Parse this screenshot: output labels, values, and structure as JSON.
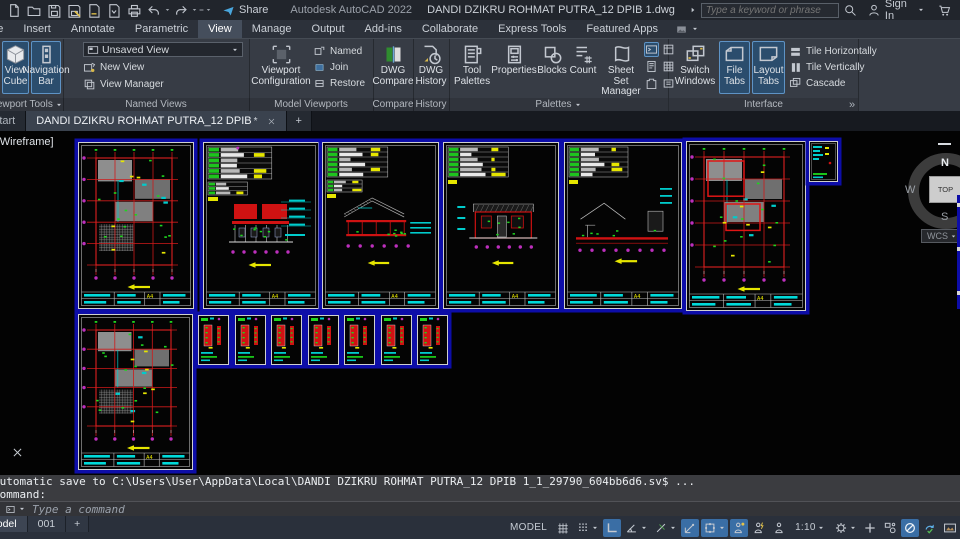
{
  "colors": {
    "highlight_blue": "#2b4d6d",
    "active_toggle": "#3a6ea5",
    "sheet_backdrop": "#0d0da8",
    "cad_red": "#cf1212",
    "cad_green": "#1fd41f",
    "cad_cyan": "#00cccc",
    "cad_magenta": "#bd2fbd",
    "cad_yellow": "#e6e600"
  },
  "titlebar": {
    "app": "Autodesk AutoCAD 2022",
    "doc": "DANDI DZIKRU ROHMAT PUTRA_12 DPIB 1.dwg",
    "share": "Share",
    "search_placeholder": "Type a keyword or phrase",
    "sign_in": "Sign In"
  },
  "menu": {
    "tabs": [
      {
        "label": "Home",
        "clip": true
      },
      {
        "label": "Insert"
      },
      {
        "label": "Annotate"
      },
      {
        "label": "Parametric"
      },
      {
        "label": "View",
        "active": true
      },
      {
        "label": "Manage"
      },
      {
        "label": "Output"
      },
      {
        "label": "Add-ins"
      },
      {
        "label": "Collaborate"
      },
      {
        "label": "Express Tools"
      },
      {
        "label": "Featured Apps"
      },
      {
        "icon": "imgbtn",
        "caret": true,
        "name": "workspace-thumbnail-menu"
      }
    ]
  },
  "ribbon": {
    "overflow": "»",
    "viewport_tools": {
      "label": "Viewport Tools",
      "view_cube": "View Cube",
      "navigation_bar": "Navigation Bar"
    },
    "named_views": {
      "label": "Named Views",
      "combo_value": "Unsaved View",
      "new_view": "New View",
      "view_manager": "View Manager"
    },
    "model_viewports": {
      "label": "Model Viewports",
      "viewport_configuration": "Viewport Configuration",
      "named": "Named",
      "join": "Join",
      "restore": "Restore"
    },
    "compare": {
      "label": "Compare",
      "dwg_compare": "DWG Compare"
    },
    "history": {
      "label": "History",
      "dwg_history": "DWG History"
    },
    "palettes": {
      "label": "Palettes",
      "tool_palettes": "Tool Palettes",
      "properties": "Properties",
      "blocks": "Blocks",
      "count": "Count",
      "sheet_set_manager": "Sheet Set Manager"
    },
    "interface": {
      "label": "Interface",
      "switch_windows": "Switch Windows",
      "file_tabs": "File Tabs",
      "layout_tabs": "Layout Tabs",
      "tile_horizontally": "Tile Horizontally",
      "tile_vertically": "Tile Vertically",
      "cascade": "Cascade"
    }
  },
  "file_tabs": {
    "start": "Start",
    "doc": "DANDI DZIKRU ROHMAT PUTRA_12 DPIB",
    "modified": "*",
    "new_tab": "+"
  },
  "canvas": {
    "vp_label": "[-][Top][2D Wireframe]",
    "viewcube": {
      "n": "N",
      "w": "W",
      "s": "S",
      "top": "TOP",
      "wcs": "WCS"
    },
    "sheets": [
      {
        "name": "sheet-1",
        "type": "plan",
        "x": 78,
        "y": 11,
        "w": 116,
        "h": 167,
        "label": "A4"
      },
      {
        "name": "sheet-2",
        "type": "elev",
        "x": 203,
        "y": 11,
        "w": 116,
        "h": 167,
        "label": "A4"
      },
      {
        "name": "sheet-3",
        "type": "sect",
        "x": 322,
        "y": 11,
        "w": 117,
        "h": 167,
        "label": "A4"
      },
      {
        "name": "sheet-4",
        "type": "elev2",
        "x": 443,
        "y": 11,
        "w": 116,
        "h": 167,
        "label": "A4"
      },
      {
        "name": "sheet-5",
        "type": "sect2",
        "x": 564,
        "y": 11,
        "w": 118,
        "h": 167,
        "label": "A4"
      },
      {
        "name": "sheet-6",
        "type": "plan2",
        "x": 686,
        "y": 10,
        "w": 120,
        "h": 170,
        "label": "A4"
      },
      {
        "name": "sheet-thumbnail",
        "type": "thumb",
        "x": 809,
        "y": 10,
        "w": 29,
        "h": 41
      },
      {
        "name": "sheet-7",
        "type": "plan3",
        "x": 78,
        "y": 183,
        "w": 115,
        "h": 156,
        "label": "A4"
      },
      {
        "name": "detail-sheet-1",
        "type": "detail",
        "x": 198,
        "y": 184,
        "w": 31,
        "h": 50
      },
      {
        "name": "detail-sheet-2",
        "type": "detail",
        "x": 235,
        "y": 184,
        "w": 31,
        "h": 50
      },
      {
        "name": "detail-sheet-3",
        "type": "detail",
        "x": 271,
        "y": 184,
        "w": 31,
        "h": 50
      },
      {
        "name": "detail-sheet-4",
        "type": "detail",
        "x": 308,
        "y": 184,
        "w": 31,
        "h": 50
      },
      {
        "name": "detail-sheet-5",
        "type": "detail",
        "x": 344,
        "y": 184,
        "w": 31,
        "h": 50
      },
      {
        "name": "detail-sheet-6",
        "type": "detail",
        "x": 381,
        "y": 184,
        "w": 31,
        "h": 50
      },
      {
        "name": "detail-sheet-7",
        "type": "detail",
        "x": 417,
        "y": 184,
        "w": 31,
        "h": 50
      }
    ]
  },
  "command": {
    "auto_save": "Automatic save to C:\\Users\\User\\AppData\\Local\\DANDI DZIKRU ROHMAT PUTRA_12 DPIB 1_1_29790_604bb6d6.sv$ ...",
    "cmd": "Command:",
    "prompt": "Type a command"
  },
  "status": {
    "model_tab": "Model",
    "layout1": "001",
    "plus_label": "+",
    "items": [
      {
        "type": "text",
        "label": "MODEL",
        "name": "model-space-toggle"
      },
      {
        "icon": "grid",
        "name": "display-grid-toggle"
      },
      {
        "icon": "snap",
        "caret": true,
        "name": "snap-mode-toggle"
      },
      {
        "icon": "ortho",
        "active": true,
        "name": "ortho-mode-toggle"
      },
      {
        "icon": "polar",
        "caret": true,
        "name": "polar-tracking-toggle"
      },
      {
        "icon": "iso",
        "caret": true,
        "name": "isometric-drafting-toggle"
      },
      {
        "icon": "otrack",
        "active": true,
        "name": "object-snap-tracking-toggle"
      },
      {
        "icon": "osnap",
        "active": true,
        "caret": true,
        "name": "object-snap-toggle"
      },
      {
        "icon": "annot1",
        "active": true,
        "name": "annotation-visibility-toggle"
      },
      {
        "icon": "annot2",
        "name": "annotation-autoscale-toggle"
      },
      {
        "icon": "annot3",
        "name": "annotation-scale-icon"
      },
      {
        "type": "text",
        "label": "1:10",
        "caret": true,
        "name": "annotation-scale-value"
      },
      {
        "icon": "gear",
        "caret": true,
        "name": "workspace-switching"
      },
      {
        "icon": "plus",
        "name": "plus-button"
      },
      {
        "icon": "isolate",
        "name": "object-isolate-settings"
      },
      {
        "icon": "circleslash",
        "active": true,
        "name": "isolate-objects-toggle"
      },
      {
        "icon": "perf",
        "name": "graphics-performance-toggle"
      },
      {
        "icon": "screen",
        "name": "clean-screen-toggle"
      },
      {
        "icon": "partial",
        "name": "clipped-status-icon"
      }
    ]
  }
}
